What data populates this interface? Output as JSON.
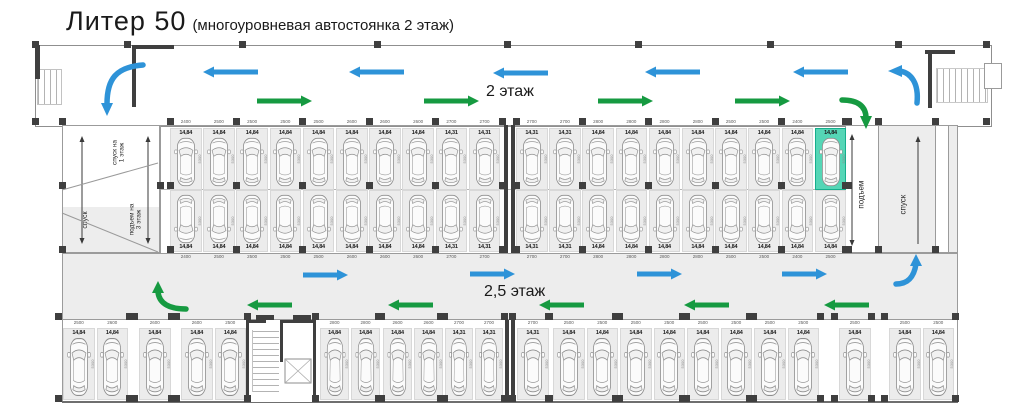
{
  "title": {
    "main": "Литер 50",
    "sub": "(многоуровневая автостоянка 2 этаж)"
  },
  "floors": {
    "top_corridor": "2 этаж",
    "middle_corridor": "2,5 этаж"
  },
  "ramps": {
    "left_top": "спуск на\n1 этаж",
    "left_bottom": "спуск",
    "left_up3": "подъем на\n3 этаж",
    "right_up": "подъем",
    "right_down": "спуск"
  },
  "colors": {
    "arrow_blue": "#2e93d8",
    "arrow_green": "#169a41",
    "highlight": "#55d6b6",
    "wall": "#3f3f3f",
    "stall_fill": "#ececec",
    "corridor_fill": "#ededed",
    "ramp_arrow": "#3a3a3a"
  },
  "dims": {
    "depth": "5300"
  },
  "rows": {
    "middle_top": {
      "stalls": [
        {
          "area": "14,84",
          "dim": "2400"
        },
        {
          "area": "14,84",
          "dim": "2500"
        },
        {
          "area": "14,84",
          "dim": "2500"
        },
        {
          "area": "14,84",
          "dim": "2500"
        },
        {
          "area": "14,84",
          "dim": "2500"
        },
        {
          "area": "14,84",
          "dim": "2600"
        },
        {
          "area": "14,84",
          "dim": "2600"
        },
        {
          "area": "14,84",
          "dim": "2600"
        },
        {
          "area": "14,31",
          "dim": "2700"
        },
        {
          "area": "14,31",
          "dim": "2700"
        },
        {
          "area": "14,31",
          "dim": "2700"
        },
        {
          "area": "14,31",
          "dim": "2700"
        },
        {
          "area": "14,84",
          "dim": "2800"
        },
        {
          "area": "14,84",
          "dim": "2800"
        },
        {
          "area": "14,84",
          "dim": "2800"
        },
        {
          "area": "14,84",
          "dim": "2800"
        },
        {
          "area": "14,84",
          "dim": "2500"
        },
        {
          "area": "14,84",
          "dim": "2500"
        },
        {
          "area": "14,84",
          "dim": "2400"
        },
        {
          "area": "14,84",
          "dim": "2500",
          "highlight": true
        }
      ]
    },
    "middle_bottom": {
      "stalls": [
        {
          "area": "14,84",
          "dim": "2400"
        },
        {
          "area": "14,84",
          "dim": "2500"
        },
        {
          "area": "14,84",
          "dim": "2500"
        },
        {
          "area": "14,84",
          "dim": "2500"
        },
        {
          "area": "14,84",
          "dim": "2500"
        },
        {
          "area": "14,84",
          "dim": "2600"
        },
        {
          "area": "14,84",
          "dim": "2600"
        },
        {
          "area": "14,84",
          "dim": "2600"
        },
        {
          "area": "14,31",
          "dim": "2700"
        },
        {
          "area": "14,31",
          "dim": "2700"
        },
        {
          "area": "14,31",
          "dim": "2700"
        },
        {
          "area": "14,31",
          "dim": "2700"
        },
        {
          "area": "14,84",
          "dim": "2800"
        },
        {
          "area": "14,84",
          "dim": "2800"
        },
        {
          "area": "14,84",
          "dim": "2800"
        },
        {
          "area": "14,84",
          "dim": "2800"
        },
        {
          "area": "14,84",
          "dim": "2500"
        },
        {
          "area": "14,84",
          "dim": "2500"
        },
        {
          "area": "14,84",
          "dim": "2400"
        },
        {
          "area": "14,84",
          "dim": "2500"
        }
      ]
    },
    "bottom": {
      "stalls": [
        {
          "area": "14,84",
          "dim": "2500"
        },
        {
          "area": "14,84",
          "dim": "2600"
        },
        {
          "area": "14,84",
          "dim": "2600"
        },
        {
          "area": "14,84",
          "dim": "2600"
        },
        {
          "area": "14,84",
          "dim": "2500"
        },
        {
          "area": "14,84",
          "dim": "2800"
        },
        {
          "area": "14,84",
          "dim": "2800"
        },
        {
          "area": "14,84",
          "dim": "2600"
        },
        {
          "area": "14,84",
          "dim": "2600"
        },
        {
          "area": "14,31",
          "dim": "2700"
        },
        {
          "area": "14,31",
          "dim": "2700"
        },
        {
          "area": "14,31",
          "dim": "2700"
        },
        {
          "area": "14,84",
          "dim": "2500"
        },
        {
          "area": "14,84",
          "dim": "2500"
        },
        {
          "area": "14,84",
          "dim": "2500"
        },
        {
          "area": "14,84",
          "dim": "2500"
        },
        {
          "area": "14,84",
          "dim": "2500"
        },
        {
          "area": "14,84",
          "dim": "2500"
        },
        {
          "area": "14,84",
          "dim": "2500"
        },
        {
          "area": "14,84",
          "dim": "2500"
        },
        {
          "area": "14,84",
          "dim": "2500"
        },
        {
          "area": "14,84",
          "dim": "2500"
        },
        {
          "area": "14,84",
          "dim": "2500"
        }
      ]
    }
  }
}
